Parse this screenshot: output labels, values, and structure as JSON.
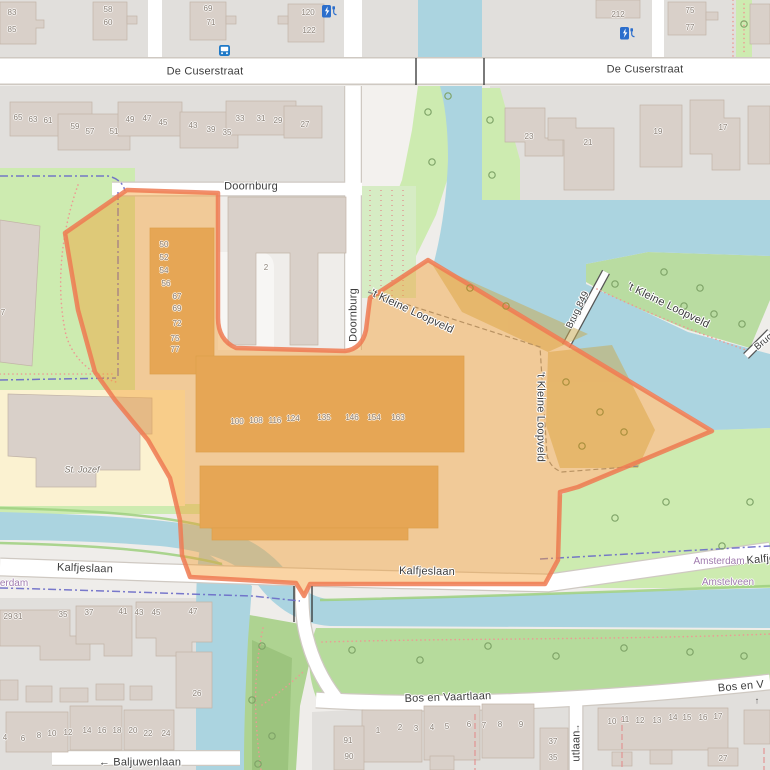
{
  "title": "Map view - Kalfjeslaan / De Cuserstraat area with highlighted zone",
  "colors": {
    "water": "#abd4e0",
    "grass": "#cdebb0",
    "residential": "#e1dfdc",
    "building": "#d9d0c9",
    "road": "#ffffff",
    "highlight_fill": "#f39d30",
    "highlight_border": "#ef7a52",
    "boundary": "#6a6ac8",
    "path_dots": "#ec9a93",
    "street_label": "#3c3c3c",
    "house_number": "#8d8379",
    "place_label": "#a07bae"
  },
  "street_labels": [
    {
      "text": "De Cuserstraat",
      "x": 205,
      "y": 72,
      "rot": 0
    },
    {
      "text": "De Cuserstraat",
      "x": 645,
      "y": 70,
      "rot": 0
    },
    {
      "text": "Doornburg",
      "x": 251,
      "y": 187,
      "rot": 0
    },
    {
      "text": "Doornburg",
      "x": 354,
      "y": 315,
      "rot": -90
    },
    {
      "text": "'t Kleine Loopveld",
      "x": 412,
      "y": 312,
      "rot": 25
    },
    {
      "text": "'t Kleine Loopveld",
      "x": 540,
      "y": 417,
      "rot": 90
    },
    {
      "text": "'t Kleine Loopveld",
      "x": 668,
      "y": 306,
      "rot": 26
    },
    {
      "text": "Brug 849",
      "x": 578,
      "y": 310,
      "rot": -64,
      "size": "sm"
    },
    {
      "text": "Brug",
      "x": 764,
      "y": 342,
      "rot": -40,
      "size": "sm"
    },
    {
      "text": "Kalfjeslaan",
      "x": 85,
      "y": 569,
      "rot": 2
    },
    {
      "text": "Kalfjeslaan",
      "x": 427,
      "y": 572,
      "rot": 1
    },
    {
      "text": "Kalfje",
      "x": 761,
      "y": 560,
      "rot": -5
    },
    {
      "text": "Bos en Vaartlaan",
      "x": 448,
      "y": 698,
      "rot": -2
    },
    {
      "text": "Bos en V",
      "x": 741,
      "y": 687,
      "rot": -5
    },
    {
      "text": "← Baljuwenlaan",
      "x": 140,
      "y": 763,
      "rot": 0
    },
    {
      "text": "utlaan",
      "x": 577,
      "y": 746,
      "rot": -90
    }
  ],
  "place_labels": [
    {
      "text": "erdam",
      "x": 14,
      "y": 584
    },
    {
      "text": "Amsterdam",
      "x": 719,
      "y": 562
    },
    {
      "text": "Amstelveen",
      "x": 728,
      "y": 583
    }
  ],
  "poi_labels": [
    {
      "text": "St. Jozef",
      "x": 82,
      "y": 470
    }
  ],
  "oneway_arrows": [
    {
      "glyph": "↑",
      "x": 757,
      "y": 701
    },
    {
      "glyph": "↑",
      "x": 578,
      "y": 728
    }
  ],
  "icons": [
    {
      "type": "charging-station",
      "x": 322,
      "y": 5
    },
    {
      "type": "charging-station",
      "x": 620,
      "y": 27
    },
    {
      "type": "bus-stop",
      "x": 219,
      "y": 45
    }
  ],
  "house_numbers": [
    {
      "t": "83",
      "x": 12,
      "y": 13
    },
    {
      "t": "85",
      "x": 12,
      "y": 30
    },
    {
      "t": "58",
      "x": 108,
      "y": 10
    },
    {
      "t": "60",
      "x": 108,
      "y": 23
    },
    {
      "t": "69",
      "x": 208,
      "y": 9
    },
    {
      "t": "71",
      "x": 211,
      "y": 23
    },
    {
      "t": "120",
      "x": 308,
      "y": 13
    },
    {
      "t": "122",
      "x": 309,
      "y": 31
    },
    {
      "t": "212",
      "x": 618,
      "y": 15
    },
    {
      "t": "75",
      "x": 690,
      "y": 11
    },
    {
      "t": "77",
      "x": 690,
      "y": 28
    },
    {
      "t": "65",
      "x": 18,
      "y": 118
    },
    {
      "t": "63",
      "x": 33,
      "y": 120
    },
    {
      "t": "61",
      "x": 48,
      "y": 121
    },
    {
      "t": "59",
      "x": 75,
      "y": 127
    },
    {
      "t": "57",
      "x": 90,
      "y": 132
    },
    {
      "t": "51",
      "x": 114,
      "y": 132
    },
    {
      "t": "49",
      "x": 130,
      "y": 120
    },
    {
      "t": "47",
      "x": 147,
      "y": 119
    },
    {
      "t": "45",
      "x": 163,
      "y": 123
    },
    {
      "t": "43",
      "x": 193,
      "y": 126
    },
    {
      "t": "39",
      "x": 211,
      "y": 130
    },
    {
      "t": "35",
      "x": 227,
      "y": 133
    },
    {
      "t": "33",
      "x": 240,
      "y": 119
    },
    {
      "t": "31",
      "x": 261,
      "y": 119
    },
    {
      "t": "29",
      "x": 278,
      "y": 121
    },
    {
      "t": "27",
      "x": 305,
      "y": 125
    },
    {
      "t": "23",
      "x": 529,
      "y": 137
    },
    {
      "t": "21",
      "x": 588,
      "y": 143
    },
    {
      "t": "19",
      "x": 658,
      "y": 132
    },
    {
      "t": "17",
      "x": 723,
      "y": 128
    },
    {
      "t": "7",
      "x": 3,
      "y": 313
    },
    {
      "t": "50",
      "x": 164,
      "y": 245
    },
    {
      "t": "52",
      "x": 164,
      "y": 258
    },
    {
      "t": "54",
      "x": 164,
      "y": 271
    },
    {
      "t": "56",
      "x": 166,
      "y": 284
    },
    {
      "t": "67",
      "x": 177,
      "y": 297
    },
    {
      "t": "69",
      "x": 177,
      "y": 309
    },
    {
      "t": "72",
      "x": 177,
      "y": 324
    },
    {
      "t": "75",
      "x": 175,
      "y": 339
    },
    {
      "t": "77",
      "x": 175,
      "y": 350
    },
    {
      "t": "2",
      "x": 266,
      "y": 268
    },
    {
      "t": "100",
      "x": 237,
      "y": 422
    },
    {
      "t": "108",
      "x": 256,
      "y": 421
    },
    {
      "t": "116",
      "x": 275,
      "y": 421
    },
    {
      "t": "124",
      "x": 293,
      "y": 419
    },
    {
      "t": "135",
      "x": 324,
      "y": 418
    },
    {
      "t": "146",
      "x": 352,
      "y": 418
    },
    {
      "t": "154",
      "x": 374,
      "y": 418
    },
    {
      "t": "163",
      "x": 398,
      "y": 418
    },
    {
      "t": "29",
      "x": 8,
      "y": 617
    },
    {
      "t": "31",
      "x": 18,
      "y": 617
    },
    {
      "t": "35",
      "x": 63,
      "y": 615
    },
    {
      "t": "37",
      "x": 89,
      "y": 613
    },
    {
      "t": "41",
      "x": 123,
      "y": 612
    },
    {
      "t": "43",
      "x": 139,
      "y": 613
    },
    {
      "t": "45",
      "x": 156,
      "y": 613
    },
    {
      "t": "47",
      "x": 193,
      "y": 612
    },
    {
      "t": "26",
      "x": 197,
      "y": 694
    },
    {
      "t": "4",
      "x": 5,
      "y": 738
    },
    {
      "t": "6",
      "x": 23,
      "y": 739
    },
    {
      "t": "8",
      "x": 39,
      "y": 736
    },
    {
      "t": "10",
      "x": 52,
      "y": 734
    },
    {
      "t": "12",
      "x": 68,
      "y": 733
    },
    {
      "t": "14",
      "x": 87,
      "y": 731
    },
    {
      "t": "16",
      "x": 102,
      "y": 731
    },
    {
      "t": "18",
      "x": 117,
      "y": 731
    },
    {
      "t": "20",
      "x": 133,
      "y": 731
    },
    {
      "t": "22",
      "x": 148,
      "y": 734
    },
    {
      "t": "24",
      "x": 166,
      "y": 734
    },
    {
      "t": "1",
      "x": 378,
      "y": 731
    },
    {
      "t": "2",
      "x": 400,
      "y": 728
    },
    {
      "t": "3",
      "x": 416,
      "y": 729
    },
    {
      "t": "4",
      "x": 432,
      "y": 728
    },
    {
      "t": "5",
      "x": 447,
      "y": 727
    },
    {
      "t": "6",
      "x": 469,
      "y": 725
    },
    {
      "t": "7",
      "x": 484,
      "y": 726
    },
    {
      "t": "8",
      "x": 500,
      "y": 725
    },
    {
      "t": "9",
      "x": 521,
      "y": 725
    },
    {
      "t": "91",
      "x": 348,
      "y": 741
    },
    {
      "t": "90",
      "x": 349,
      "y": 757
    },
    {
      "t": "37",
      "x": 553,
      "y": 742
    },
    {
      "t": "35",
      "x": 553,
      "y": 758
    },
    {
      "t": "10",
      "x": 612,
      "y": 722
    },
    {
      "t": "11",
      "x": 625,
      "y": 720
    },
    {
      "t": "12",
      "x": 640,
      "y": 721
    },
    {
      "t": "13",
      "x": 657,
      "y": 721
    },
    {
      "t": "14",
      "x": 673,
      "y": 718
    },
    {
      "t": "15",
      "x": 687,
      "y": 718
    },
    {
      "t": "16",
      "x": 703,
      "y": 718
    },
    {
      "t": "17",
      "x": 718,
      "y": 717
    },
    {
      "t": "27",
      "x": 723,
      "y": 759
    }
  ]
}
